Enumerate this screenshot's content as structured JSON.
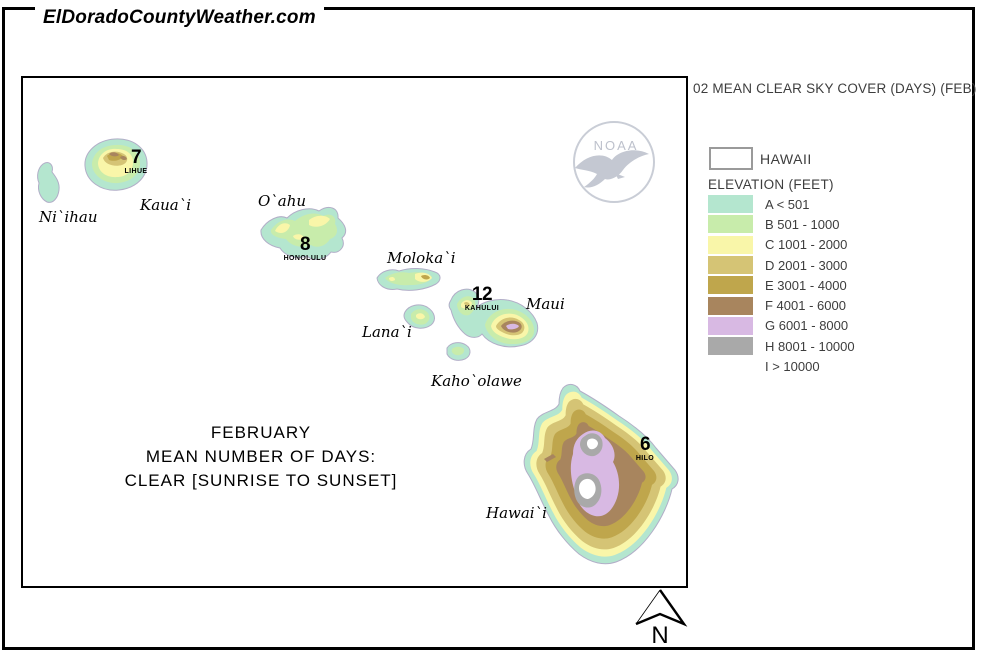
{
  "header": {
    "site_title": "ElDoradoCountyWeather.com"
  },
  "panel": {
    "title": "02 MEAN CLEAR SKY COVER (DAYS) (FEB)",
    "region_label": "HAWAII",
    "elevation_title": "ELEVATION (FEET)",
    "entries": [
      {
        "label": "A < 501",
        "color": "#b4e6cf"
      },
      {
        "label": "B 501 - 1000",
        "color": "#c8ecab"
      },
      {
        "label": "C 1001 - 2000",
        "color": "#f9f6a9"
      },
      {
        "label": "D 2001 - 3000",
        "color": "#d5c475"
      },
      {
        "label": "E 3001 - 4000",
        "color": "#bfa64c"
      },
      {
        "label": "F 4001 - 6000",
        "color": "#a8855e"
      },
      {
        "label": "G 6001 - 8000",
        "color": "#d8b9e3"
      },
      {
        "label": "H 8001 - 10000",
        "color": "#a9a9a9"
      },
      {
        "label": "I > 10000",
        "color": "#ffffff"
      }
    ]
  },
  "map": {
    "caption": [
      "FEBRUARY",
      "MEAN NUMBER OF DAYS:",
      "CLEAR [SUNRISE TO SUNSET]"
    ],
    "islands": {
      "niihau": {
        "name": "Ni`ihau"
      },
      "kauai": {
        "name": "Kaua`i",
        "value": "7",
        "station": "LIHUE"
      },
      "oahu": {
        "name": "O`ahu",
        "value": "8",
        "station": "HONOLULU"
      },
      "molokai": {
        "name": "Moloka`i"
      },
      "lanai": {
        "name": "Lana`i"
      },
      "maui": {
        "name": "Maui",
        "value": "12",
        "station": "KAHULUI"
      },
      "kahoolawe": {
        "name": "Kaho`olawe"
      },
      "hawaii": {
        "name": "Hawai`i",
        "value": "6",
        "station": "HILO"
      }
    },
    "noaa_text": "NOAA",
    "north_label": "N"
  }
}
